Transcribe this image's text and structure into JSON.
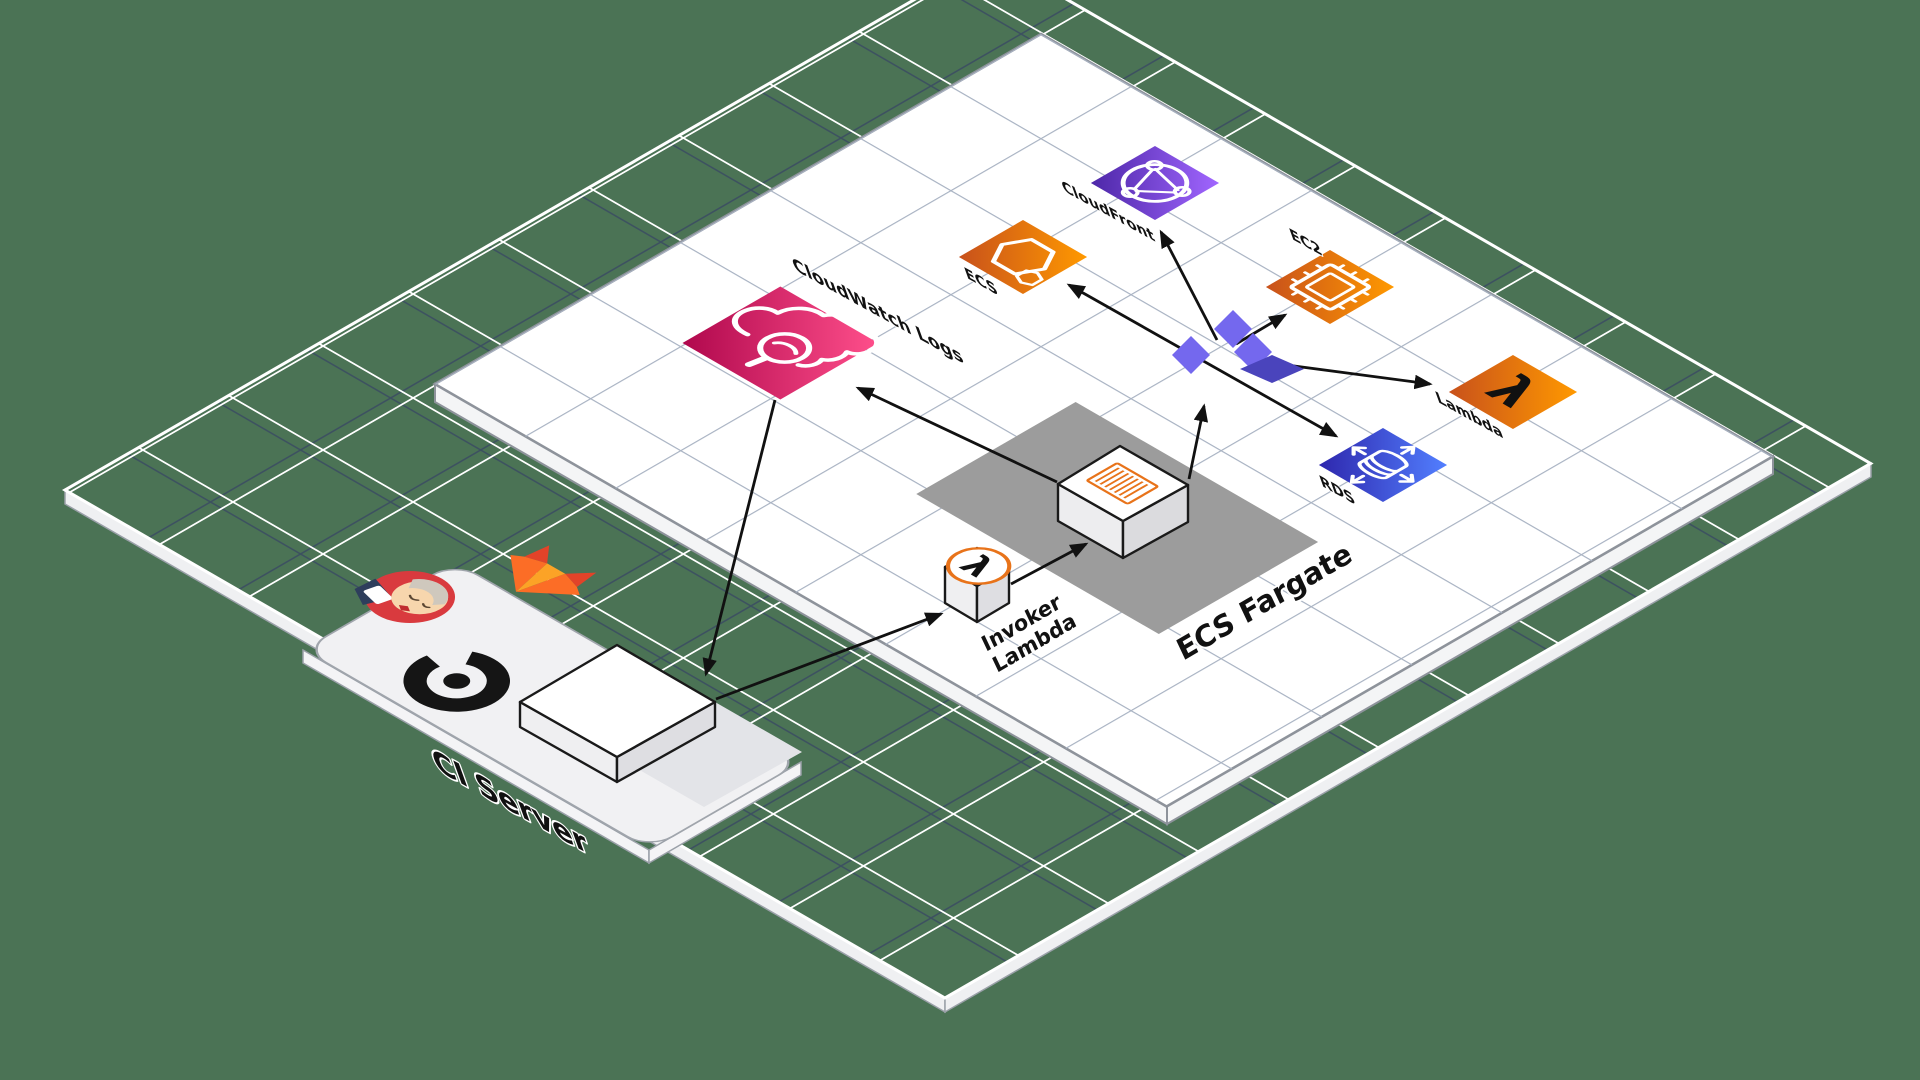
{
  "title": "Isometric AWS deployment architecture diagram",
  "colors": {
    "background_green": "#4B7355",
    "base_grid_white": "#FFFFFF",
    "base_grid_dark": "#3A4A63",
    "platform_white": "#FFFFFF",
    "platform_grid": "#A9B3C3",
    "fargate_zone_gray": "#9C9C9C",
    "aws_pink_from": "#B0084D",
    "aws_pink_to": "#FF4F8B",
    "aws_orange_from": "#C8511B",
    "aws_orange_to": "#FF9900",
    "aws_purple_from": "#4D27A8",
    "aws_purple_to": "#A166FF",
    "aws_blue_from": "#2E27AD",
    "aws_blue_to": "#527FFF",
    "terraform_light": "#7468EE",
    "terraform_dark": "#4A44BC",
    "gitlab_red": "#E24329",
    "gitlab_orange": "#FC6D26",
    "gitlab_yellow": "#FCA326",
    "arrow_black": "#111111"
  },
  "diagram": {
    "nodes": [
      {
        "id": "cloudwatch-logs",
        "label": "CloudWatch Logs",
        "icon": "cloud-magnifier-icon",
        "color": "pink"
      },
      {
        "id": "cloudfront",
        "label": "CloudFront",
        "icon": "globe-network-icon",
        "color": "purple"
      },
      {
        "id": "ecs",
        "label": "ECS",
        "icon": "hexagon-icon",
        "color": "orange"
      },
      {
        "id": "ec2",
        "label": "EC2",
        "icon": "chip-icon",
        "color": "orange"
      },
      {
        "id": "lambda",
        "label": "Lambda",
        "icon": "lambda-icon",
        "color": "orange",
        "glyph": "λ"
      },
      {
        "id": "rds",
        "label": "RDS",
        "icon": "database-arrows-icon",
        "color": "blue"
      },
      {
        "id": "invoker-lambda",
        "label_line1": "Invoker",
        "label_line2": "Lambda",
        "icon": "lambda-badge-icon",
        "glyph": "λ"
      },
      {
        "id": "ci-build-box",
        "label": "",
        "icon": "white-box"
      },
      {
        "id": "fargate-task-box",
        "label": "",
        "icon": "container-stripes-icon"
      },
      {
        "id": "terraform-hub",
        "icon": "terraform-pinwheel-icon"
      }
    ],
    "zones": [
      {
        "id": "ecs-fargate",
        "label": "ECS Fargate"
      }
    ],
    "platforms": [
      {
        "id": "ci-server",
        "label": "CI Server",
        "logos": [
          "jenkins-mascot",
          "gitlab-logo",
          "b-ring-logo"
        ]
      },
      {
        "id": "aws-platform",
        "label": ""
      }
    ],
    "arrows": [
      {
        "from": "cloudwatch-logs",
        "to": "ci-build-box",
        "double": false
      },
      {
        "from": "ci-build-box",
        "to": "invoker-lambda",
        "double": false
      },
      {
        "from": "invoker-lambda",
        "to": "fargate-task-box",
        "double": false
      },
      {
        "from": "fargate-task-box",
        "to": "terraform-hub",
        "double": false
      },
      {
        "from": "fargate-task-box",
        "to": "cloudwatch-logs",
        "double": false
      },
      {
        "from": "terraform-hub",
        "to": "cloudfront",
        "double": false
      },
      {
        "from": "rds",
        "to": "ecs",
        "double": true
      },
      {
        "from": "terraform-hub",
        "to": "ec2",
        "double": false
      },
      {
        "from": "terraform-hub",
        "to": "lambda",
        "double": false
      }
    ]
  }
}
